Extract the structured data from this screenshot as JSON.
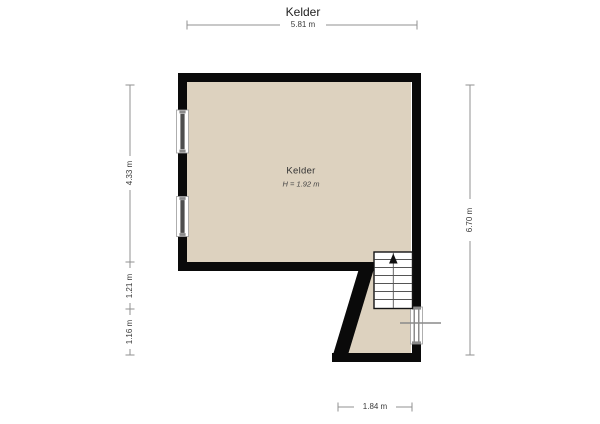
{
  "page_title": "Kelder",
  "floorplan": {
    "room": {
      "name": "Kelder",
      "height_label": "H = 1.92 m"
    },
    "dimensions": {
      "top": "5.81 m",
      "left_segments": [
        "4.33 m",
        "1.21 m",
        "1.16 m"
      ],
      "right": "6.70 m",
      "bottom": "1.84 m"
    },
    "icons": {
      "stairs_direction": "up-arrow"
    },
    "colors": {
      "floor": "#ddd2bf",
      "wall": "#0a0a0a",
      "dimension-line": "#909090",
      "dimension-text": "#3a3a3a",
      "stair-tread": "#555555",
      "window-glass": "#4e4e4e"
    }
  }
}
